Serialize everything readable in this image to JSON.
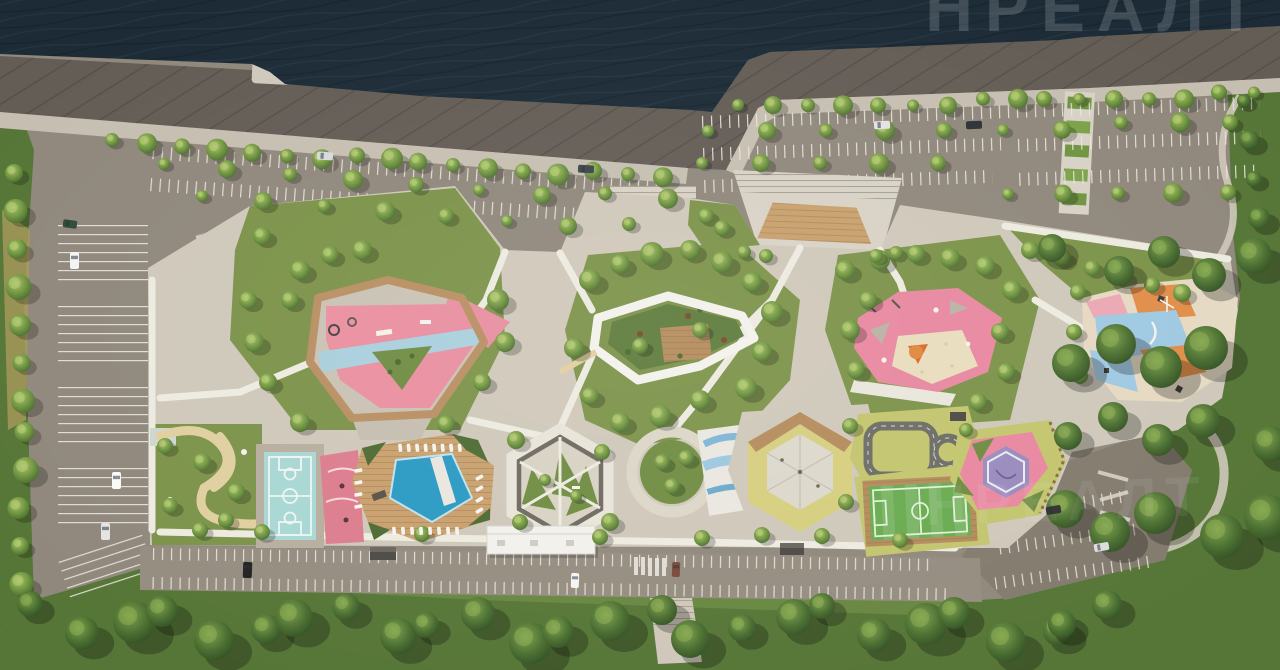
{
  "watermark": {
    "text": "НРЕАЛТ",
    "repeat_text": "НРЕАЛТ"
  },
  "palette": {
    "water": "#1c2b36",
    "wave": "#27394a",
    "embankment": "#645d56",
    "embankment_stripe": "#4e4a44",
    "walkway": "#c6bfb1",
    "asphalt": "#90887c",
    "asphalt_dark": "#837b6e",
    "stall_line": "#eae6dd",
    "paving": "#cfc8ba",
    "plaza": "#d8d2c6",
    "path_white": "#edebe0",
    "lawn": "#7c934a",
    "lawn_dark": "#5f7c3c",
    "meadow": "#c3c56e",
    "forest": "#567637",
    "tree_light": "#a9c369",
    "tree_dark": "#44662d",
    "wood": "#b48c5c",
    "deck": "#c9a06d",
    "pink": "#e98fa0",
    "rose": "#dc7d8e",
    "pink_east": "#e888a0",
    "purple": "#998cbe",
    "blue_band": "#a9cfdc",
    "pool": "#2b9ac3",
    "teal_court": "#a8d7d3",
    "skate_blue": "#7fb5d5",
    "yellow_ring": "#d6ce7e",
    "field_green": "#69ab50",
    "orange": "#e0883f",
    "sand": "#e5d9c2",
    "patch_blue": "#9fc9e2",
    "white_struct": "#f2f1ec",
    "shed": "#4e4a45",
    "watermark": "rgba(255,255,255,0.17)"
  },
  "regions": {
    "water": "River",
    "promenade": "Embankment promenade",
    "pier": "Stone pier",
    "pergola": "Planted pergola",
    "parking_nw": "North-west parking",
    "parking_ne": "North-east parking",
    "parking_w": "West parking",
    "parking_se": "South-east parking",
    "road_s": "South access road",
    "entrance_plaza": "Main entrance plaza",
    "courtyard": "Residential courtyard",
    "playground_w": "West playground",
    "pool": "Swimming pool deck",
    "basketball": "Basketball court",
    "court_rose": "Rose sports court",
    "garden_w": "West garden",
    "hex_garden": "Hexagon quiet garden",
    "circular_garden": "Circular garden",
    "skate": "Skate spot",
    "event_hex": "Event hexagon",
    "traffic_town": "Kids traffic town",
    "football": "Mini football field",
    "court_pink": "Street workout court",
    "playground_e": "East playground",
    "playground_patchwork": "Patchwork playground",
    "pavilion": "Central pavilion garden",
    "building": "Service pavilion",
    "forest_b": "South woodland",
    "forest_r": "East woodland",
    "green_w": "West green strip",
    "trees": "Trees",
    "cars": "Parked cars",
    "furniture": "Sun loungers"
  }
}
